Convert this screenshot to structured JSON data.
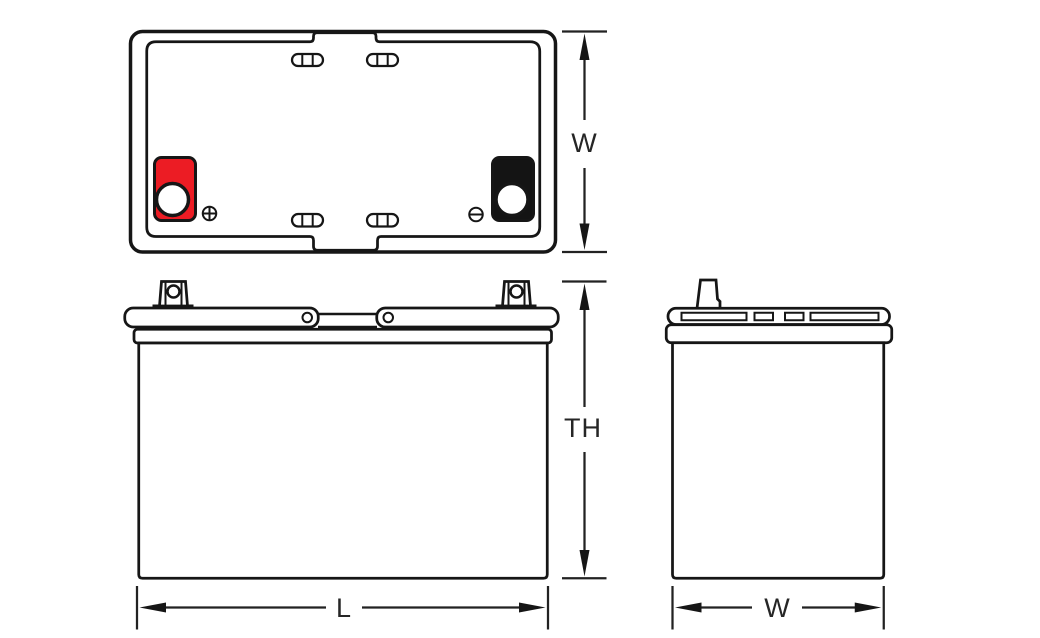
{
  "diagram": {
    "dimensions": {
      "width_top": "W",
      "total_height": "TH",
      "length": "L",
      "width_side": "W"
    },
    "markers": {
      "positive_marker_icon": "circled-plus",
      "negative_marker_icon": "circled-minus"
    },
    "colors": {
      "positive_red": "#ec1c24",
      "negative_black": "#141414",
      "line": "#161616"
    }
  }
}
